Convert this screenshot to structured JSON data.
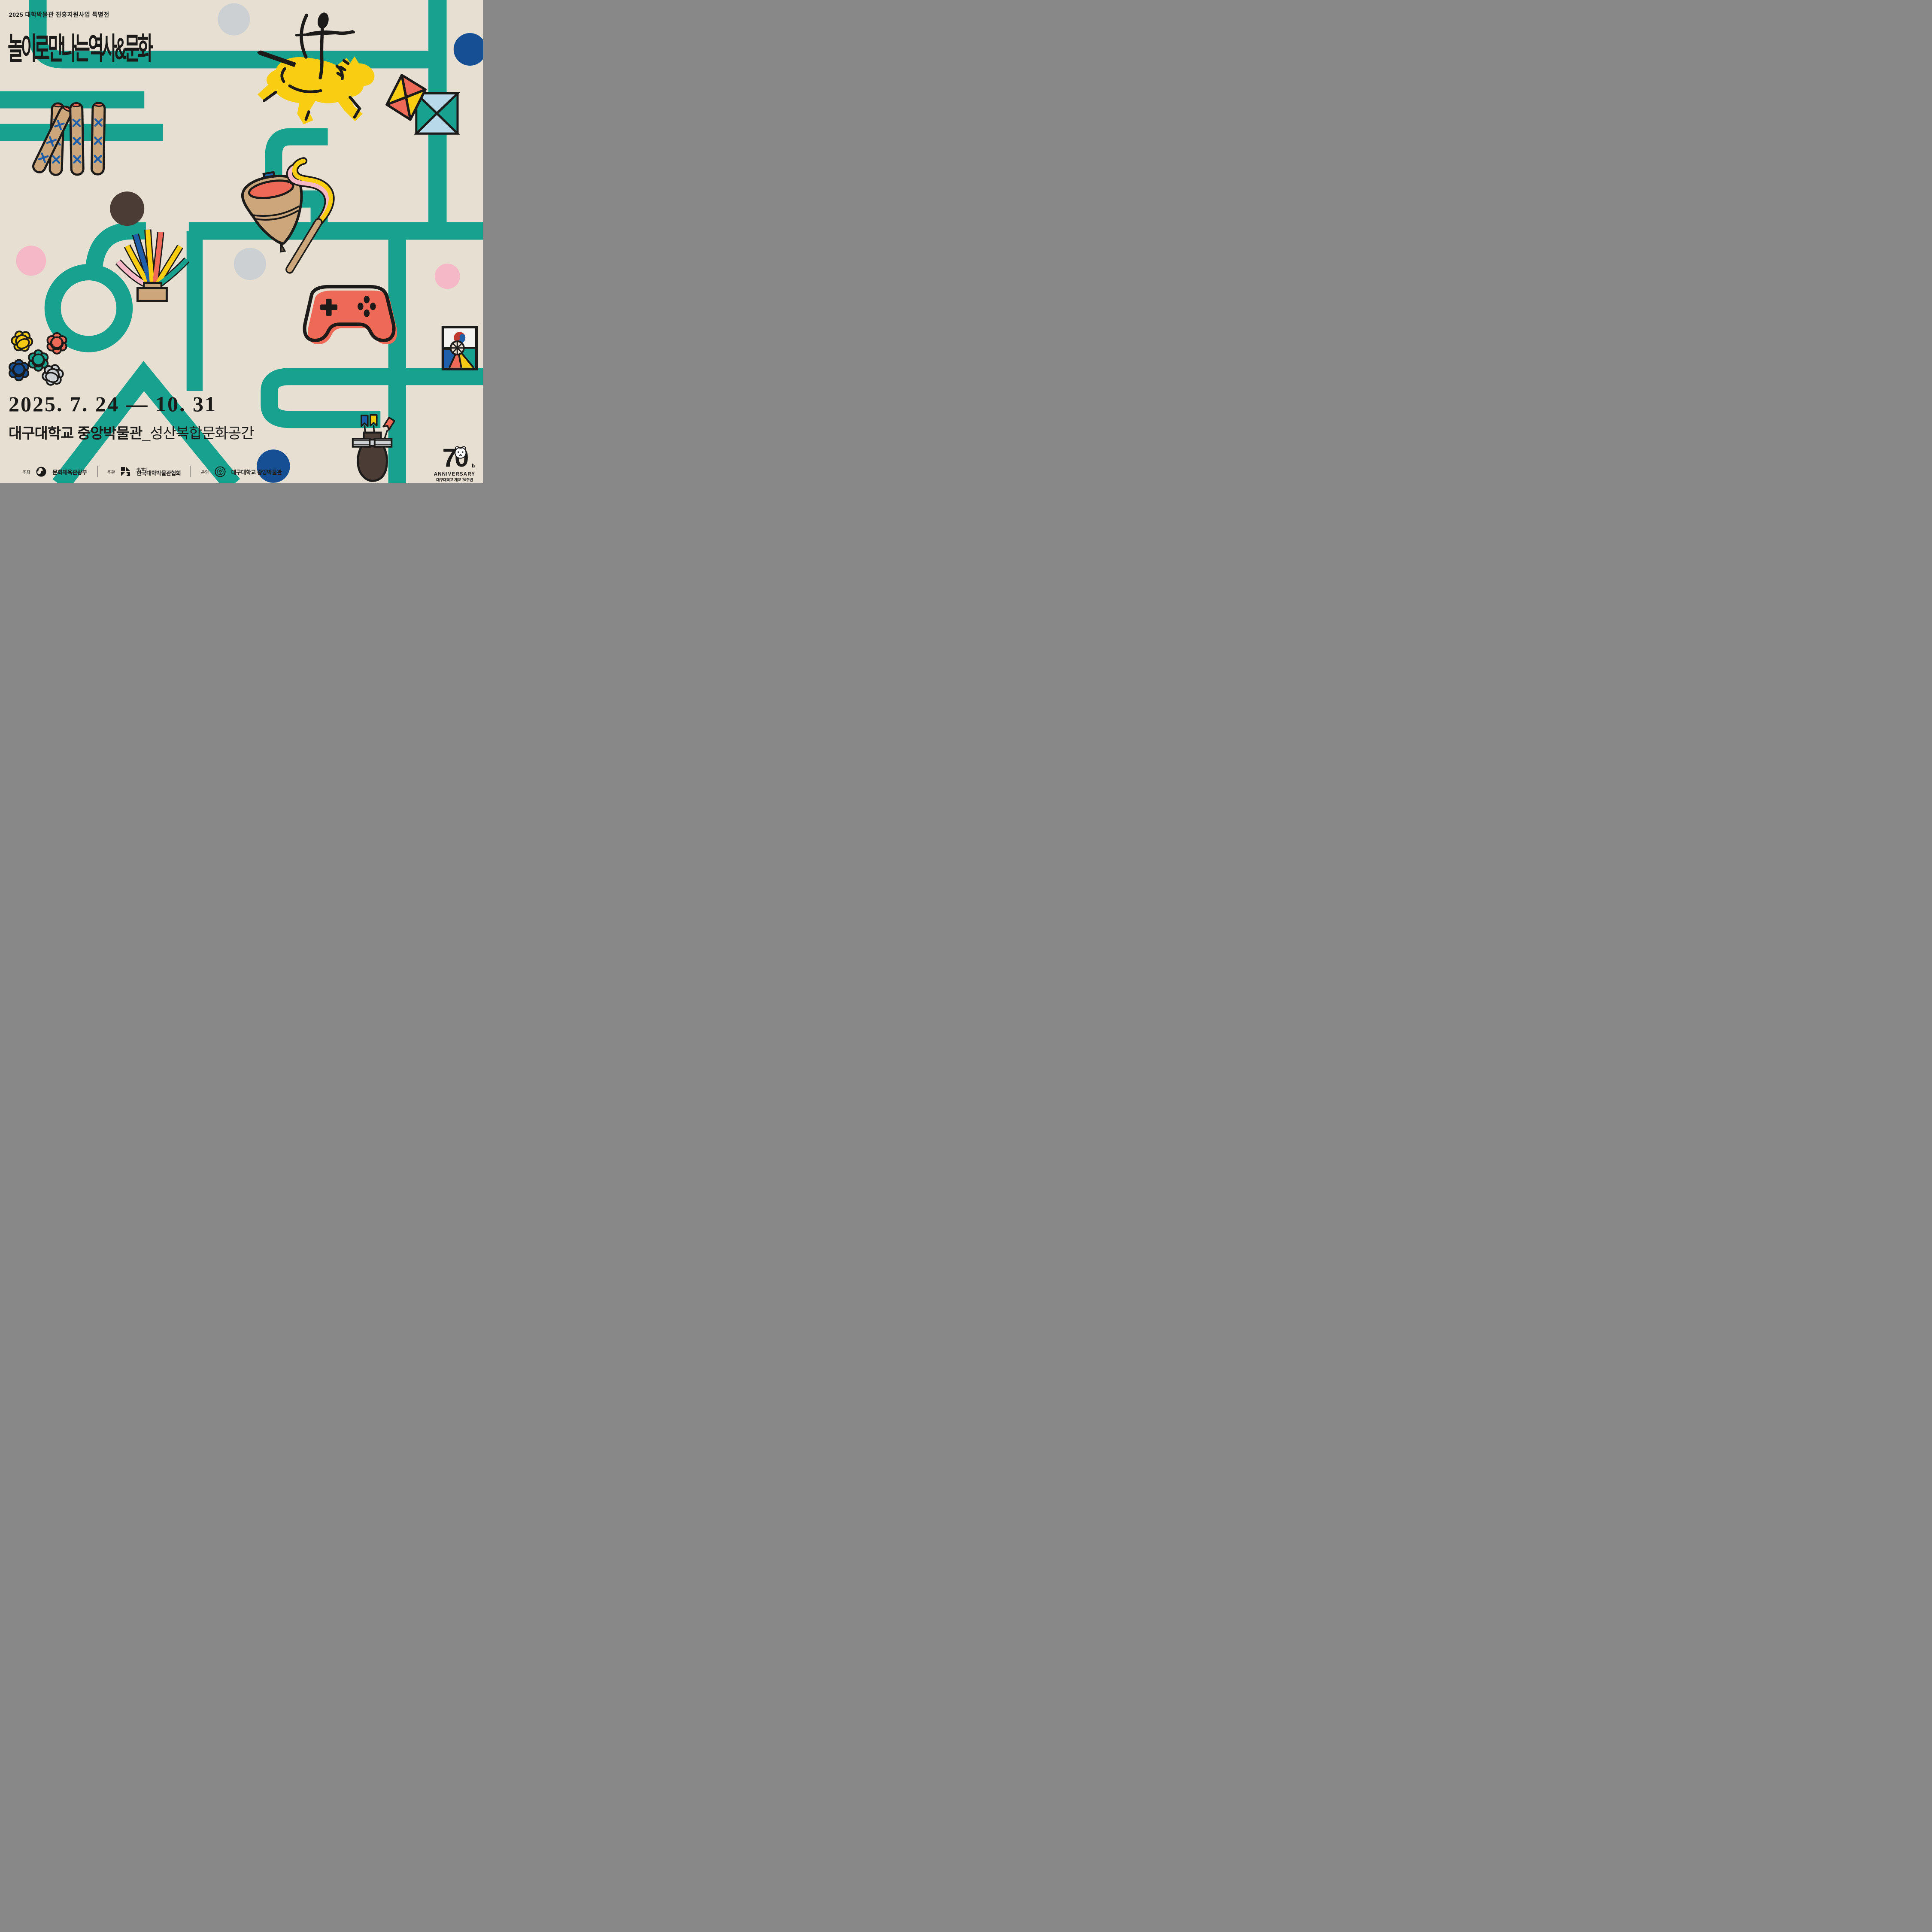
{
  "poster": {
    "eyebrow": "2025 대학박물관 진흥지원사업 특별전",
    "title": "놀이로 만나는 역사&문화",
    "date_range": "2025. 7. 24 — 10. 31",
    "venue": {
      "name": "대구대학교 중앙박물관",
      "space": "_성산복합문화공간"
    },
    "credits": [
      {
        "role": "주최",
        "org": "문화체육관광부",
        "org_sub": ""
      },
      {
        "role": "주관",
        "org": "한국대학박물관협회",
        "org_sub": "사단법인"
      },
      {
        "role": "운영",
        "org": "대구대학교 중앙박물관",
        "org_sub": ""
      }
    ],
    "anniversary": {
      "number": "70",
      "suffix": "th",
      "word": "ANNIVERSARY",
      "line1": "대구대학교 개교 70주년",
      "years": "1956 ▶ 2026"
    },
    "colors": {
      "background": "#E7DFD2",
      "teal": "#17A290",
      "yellow": "#F9CD12",
      "coral": "#EE6A57",
      "blue": "#1F5EA8",
      "navy": "#164F93",
      "pink": "#F5B8C6",
      "light_blue": "#B8D9EA",
      "tan": "#CDA77C",
      "dark_brown": "#4B3D35",
      "silver": "#CCD0D3",
      "black": "#1D1B19"
    }
  }
}
